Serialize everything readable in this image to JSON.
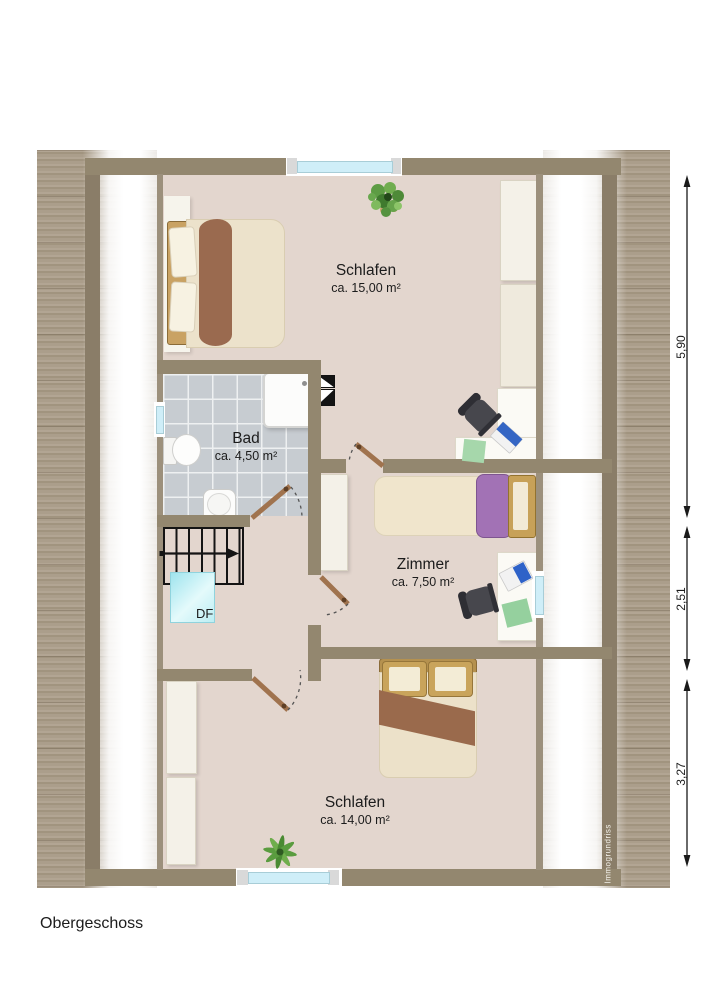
{
  "page": {
    "title": "Obergeschoss",
    "watermark": "Immogrundriss"
  },
  "rooms": {
    "schlafen_top": {
      "name": "Schlafen",
      "area": "ca. 15,00 m²"
    },
    "bad": {
      "name": "Bad",
      "area": "ca. 4,50 m²"
    },
    "zimmer": {
      "name": "Zimmer",
      "area": "ca. 7,50 m²"
    },
    "schlafen_bottom": {
      "name": "Schlafen",
      "area": "ca. 14,00 m²"
    }
  },
  "skylight": {
    "label": "DF"
  },
  "dimensions": {
    "right_top": "5,90",
    "right_middle": "2,51",
    "right_bottom": "3,27"
  },
  "colors": {
    "wall": "#93876f",
    "floor": "#e3d6ce",
    "tile": "#c7ccd1",
    "window_glass": "#cfeef8",
    "door_leaf": "#a0734e",
    "roof_hatch": "#ab9e8b",
    "skylight": "#bfeef4",
    "bed_blanket_brown": "#9a6a4c",
    "bed_blanket_purple": "#a272b5"
  }
}
